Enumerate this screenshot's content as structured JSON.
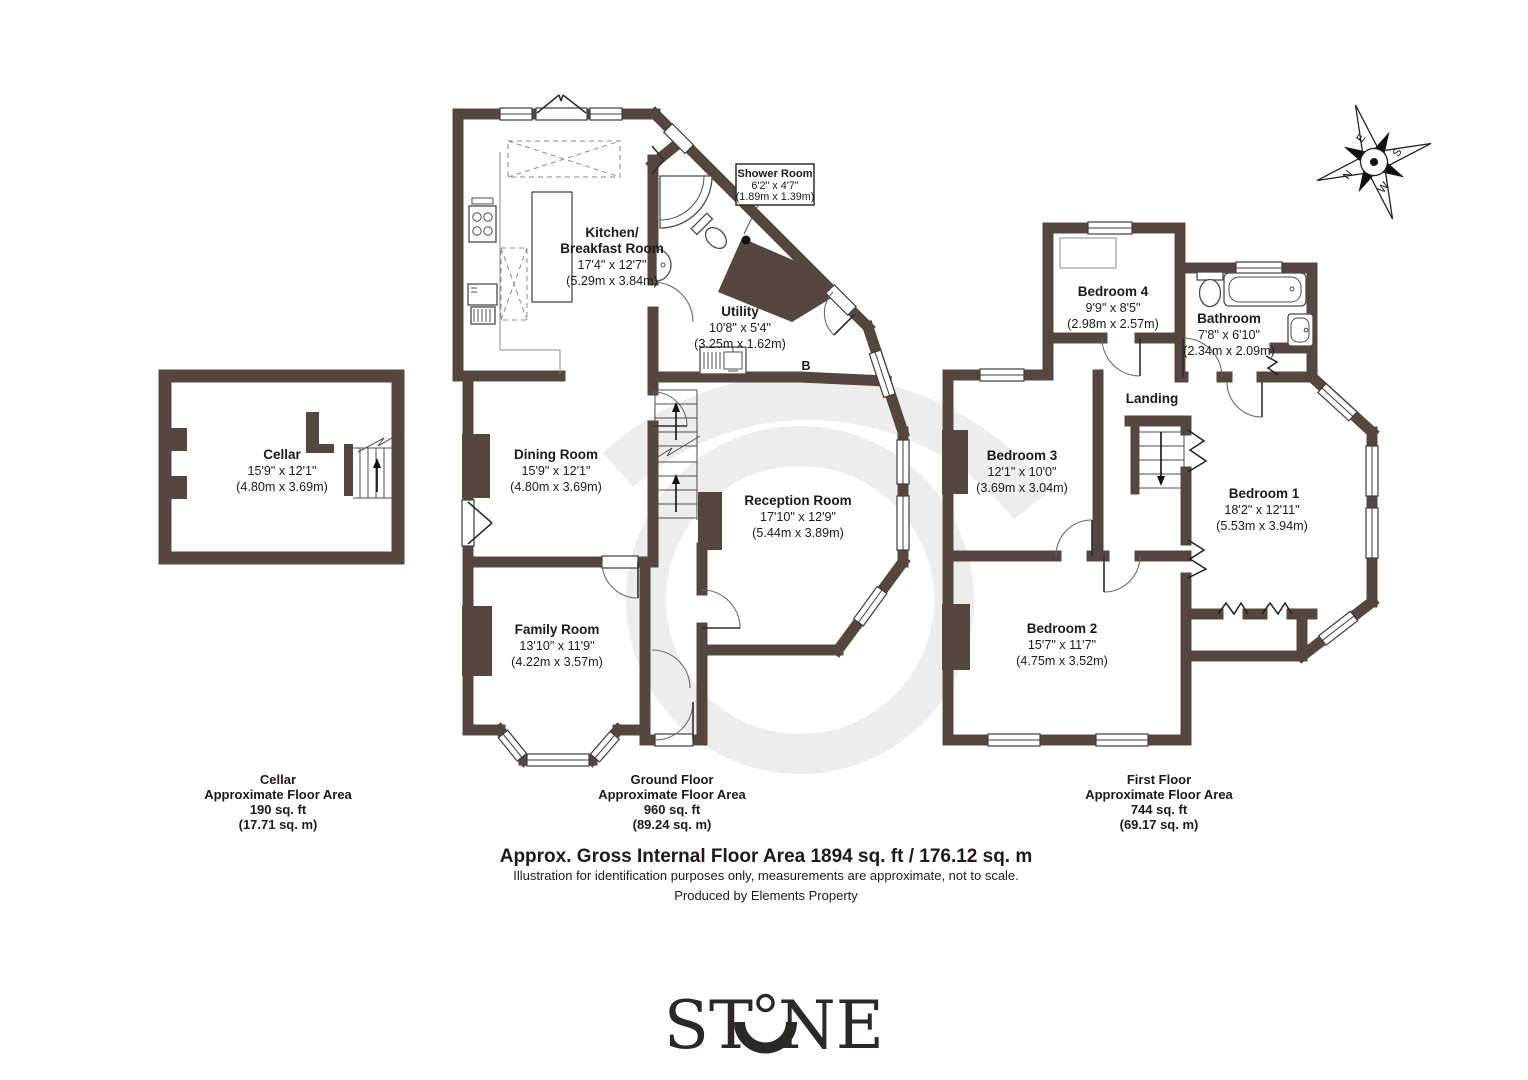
{
  "colors": {
    "wall": "#55473f",
    "text": "#1d1a19",
    "watermark": "#ededed",
    "logo": "#2b2827"
  },
  "compass": {
    "north": "N",
    "east": "E",
    "south": "S",
    "west": "W"
  },
  "cellar": {
    "room": {
      "name": "Cellar",
      "size_ft": "15'9\" x 12'1\"",
      "size_m": "(4.80m x 3.69m)"
    },
    "footer": {
      "title": "Cellar",
      "area_label": "Approximate Floor Area",
      "area_ft": "190 sq. ft",
      "area_m": "(17.71 sq. m)"
    }
  },
  "ground": {
    "kitchen": {
      "name1": "Kitchen/",
      "name2": "Breakfast Room",
      "size_ft": "17'4\" x 12'7\"",
      "size_m": "(5.29m x 3.84m)"
    },
    "shower": {
      "name": "Shower Room",
      "size_ft": "6'2\" x 4'7\"",
      "size_m": "(1.89m x 1.39m)"
    },
    "utility": {
      "name": "Utility",
      "size_ft": "10'8\" x 5'4\"",
      "size_m": "(3.25m x 1.62m)"
    },
    "dining": {
      "name": "Dining Room",
      "size_ft": "15'9\" x 12'1\"",
      "size_m": "(4.80m x 3.69m)"
    },
    "reception": {
      "name": "Reception Room",
      "size_ft": "17'10\" x 12'9\"",
      "size_m": "(5.44m x 3.89m)"
    },
    "family": {
      "name": "Family Room",
      "size_ft": "13'10\" x 11'9\"",
      "size_m": "(4.22m x 3.57m)"
    },
    "boiler": "B",
    "footer": {
      "title": "Ground Floor",
      "area_label": "Approximate Floor Area",
      "area_ft": "960 sq. ft",
      "area_m": "(89.24 sq. m)"
    }
  },
  "first": {
    "bedroom1": {
      "name": "Bedroom 1",
      "size_ft": "18'2\" x 12'11\"",
      "size_m": "(5.53m x 3.94m)"
    },
    "bedroom2": {
      "name": "Bedroom 2",
      "size_ft": "15'7\" x 11'7\"",
      "size_m": "(4.75m x 3.52m)"
    },
    "bedroom3": {
      "name": "Bedroom 3",
      "size_ft": "12'1\" x 10'0\"",
      "size_m": "(3.69m x 3.04m)"
    },
    "bedroom4": {
      "name": "Bedroom 4",
      "size_ft": "9'9\" x 8'5\"",
      "size_m": "(2.98m x 2.57m)"
    },
    "bathroom": {
      "name": "Bathroom",
      "size_ft": "7'8\" x 6'10\"",
      "size_m": "(2.34m x 2.09m)"
    },
    "landing": "Landing",
    "footer": {
      "title": "First Floor",
      "area_label": "Approximate Floor Area",
      "area_ft": "744 sq. ft",
      "area_m": "(69.17 sq. m)"
    }
  },
  "summary": {
    "title": "Approx. Gross Internal Floor Area 1894 sq. ft / 176.12 sq. m",
    "disclaimer": "Illustration for identification purposes only, measurements are approximate, not to scale.",
    "producer": "Produced by Elements Property"
  },
  "logo": {
    "part1": "ST",
    "part2": "NE",
    "brand": "STONE"
  }
}
